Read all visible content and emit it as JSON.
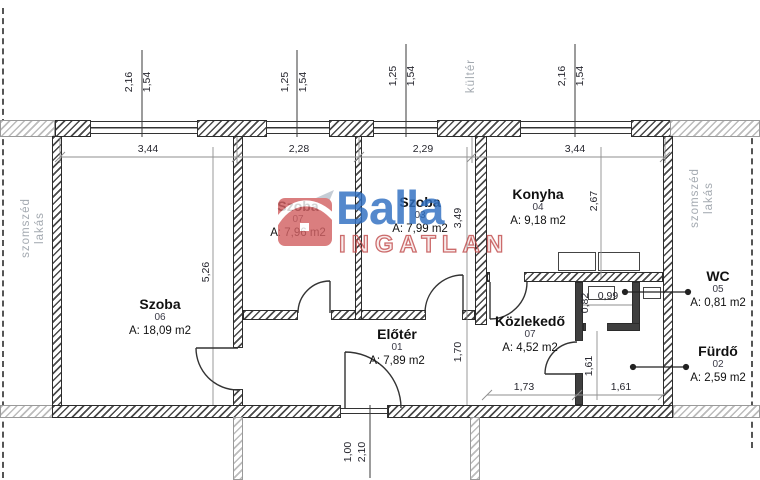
{
  "watermark": {
    "brand": "Balla",
    "sub": "INGATLAN",
    "accent_blue": "#2f6fc1",
    "accent_red": "#c14b4b"
  },
  "context_labels": {
    "left_neighbor_line1": "szomszéd",
    "left_neighbor_line2": "lakás",
    "right_neighbor_line1": "szomszéd",
    "right_neighbor_line2": "lakás",
    "outdoor": "kültér"
  },
  "rooms": {
    "szoba06": {
      "name": "Szoba",
      "num": "06",
      "area": "A: 18,09 m2"
    },
    "szoba07": {
      "name": "Szoba",
      "num": "07",
      "area": "A: 7,96 m2"
    },
    "szoba03": {
      "name": "Szoba",
      "num": "03",
      "area": "A: 7,99 m2"
    },
    "konyha": {
      "name": "Konyha",
      "num": "04",
      "area": "A: 9,18 m2"
    },
    "eloter": {
      "name": "Előtér",
      "num": "01",
      "area": "A: 7,89 m2"
    },
    "kozlekedo": {
      "name": "Közlekedő",
      "num": "07",
      "area": "A: 4,52 m2"
    },
    "wc": {
      "name": "WC",
      "num": "05",
      "area": "A: 0,81 m2"
    },
    "furdo": {
      "name": "Fürdő",
      "num": "02",
      "area": "A: 2,59 m2"
    }
  },
  "dims": {
    "w1_a": "2,16",
    "w1_b": "1,54",
    "w2_a": "1,25",
    "w2_b": "1,54",
    "w3_a": "1,25",
    "w3_b": "1,54",
    "w4_a": "2,16",
    "w4_b": "1,54",
    "top_1": "3,44",
    "top_2": "2,28",
    "top_3": "2,29",
    "top_4": "3,44",
    "szoba06_h": "5,26",
    "szoba03_h": "3,49",
    "konyha_h": "2,67",
    "eloter_h": "1,70",
    "furdo_h": "1,61",
    "wc_h": "0,82",
    "wc_w": "0,99",
    "kozlekedo_w": "1,73",
    "furdo_w": "1,61",
    "door_w": "1,00",
    "door_h": "2,10"
  }
}
